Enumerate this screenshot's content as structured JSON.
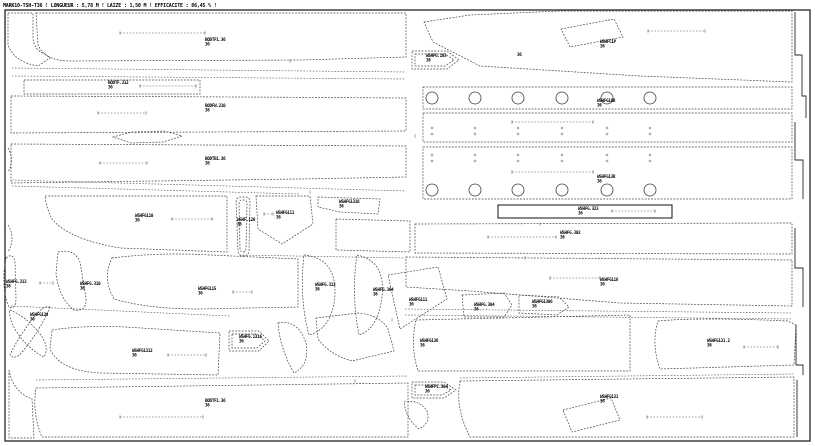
{
  "header": {
    "text": "MARK10-TSH-T36 ! LONGUEUR : 5,78 M ! LAIZE : 1,50 M ! EFFICACITE : 86,45 % !"
  },
  "canvas": {
    "background": "#ffffff",
    "line_color": "#3c3c3c",
    "label_color": "#000000"
  },
  "pieces": [
    {
      "label": "BODTF1.36",
      "size": "36",
      "x": 205,
      "y": 41
    },
    {
      "label": "WSHFC1P",
      "size": "36",
      "x": 600,
      "y": 43
    },
    {
      "label": "WSHFG.103",
      "size": "36",
      "x": 426,
      "y": 57
    },
    {
      "label": "36",
      "size": "",
      "x": 517,
      "y": 56
    },
    {
      "label": "WSHFG10B",
      "size": "36",
      "x": 597,
      "y": 102
    },
    {
      "label": "BODTF.312",
      "size": "36",
      "x": 108,
      "y": 84
    },
    {
      "label": "BODFW.210",
      "size": "36",
      "x": 205,
      "y": 107
    },
    {
      "label": "BODTB1.36",
      "size": "36",
      "x": 205,
      "y": 160
    },
    {
      "label": "WSHFG13B",
      "size": "36",
      "x": 597,
      "y": 178
    },
    {
      "label": "WSHFG110",
      "size": "36",
      "x": 135,
      "y": 217
    },
    {
      "label": "WSHF.120",
      "size": "36",
      "x": 237,
      "y": 221
    },
    {
      "label": "WSHFG111",
      "size": "36",
      "x": 276,
      "y": 214
    },
    {
      "label": "WSHFG1316",
      "size": "36",
      "x": 339,
      "y": 203
    },
    {
      "label": "WSHFG.323",
      "size": "36",
      "x": 578,
      "y": 210
    },
    {
      "label": "WSHFG.302",
      "size": "36",
      "x": 560,
      "y": 234
    },
    {
      "label": "WSHFG.313",
      "size": "36",
      "x": 6,
      "y": 283
    },
    {
      "label": "WSHFG.310",
      "size": "36",
      "x": 80,
      "y": 285
    },
    {
      "label": "WSHFG115",
      "size": "36",
      "x": 198,
      "y": 290
    },
    {
      "label": "WSHFG.313",
      "size": "36",
      "x": 315,
      "y": 286
    },
    {
      "label": "WSHFG.304",
      "size": "36",
      "x": 373,
      "y": 291
    },
    {
      "label": "WSHFG111",
      "size": "36",
      "x": 409,
      "y": 301
    },
    {
      "label": "WSHFG.304",
      "size": "36",
      "x": 474,
      "y": 306
    },
    {
      "label": "WSHFG1306",
      "size": "36",
      "x": 532,
      "y": 303
    },
    {
      "label": "WSHFG116",
      "size": "36",
      "x": 600,
      "y": 281
    },
    {
      "label": "WSHFG138",
      "size": "36",
      "x": 30,
      "y": 316
    },
    {
      "label": "WSHFG1312",
      "size": "36",
      "x": 132,
      "y": 352
    },
    {
      "label": "WSHFG.1316",
      "size": "36",
      "x": 239,
      "y": 338
    },
    {
      "label": "WSHFG136",
      "size": "36",
      "x": 420,
      "y": 342
    },
    {
      "label": "WSHFG131.2",
      "size": "36",
      "x": 707,
      "y": 342
    },
    {
      "label": "WSHFPL.304",
      "size": "36",
      "x": 425,
      "y": 388
    },
    {
      "label": "WSHFG131",
      "size": "36",
      "x": 600,
      "y": 398
    },
    {
      "label": "BODTF1.36",
      "size": "36",
      "x": 205,
      "y": 402
    }
  ],
  "grain_lines": [
    {
      "x1": 120,
      "y1": 33,
      "x2": 205,
      "y2": 33
    },
    {
      "x1": 648,
      "y1": 31,
      "x2": 705,
      "y2": 31
    },
    {
      "x1": 140,
      "y1": 86,
      "x2": 196,
      "y2": 86
    },
    {
      "x1": 98,
      "y1": 113,
      "x2": 146,
      "y2": 113
    },
    {
      "x1": 100,
      "y1": 163,
      "x2": 147,
      "y2": 163
    },
    {
      "x1": 512,
      "y1": 122,
      "x2": 593,
      "y2": 122
    },
    {
      "x1": 512,
      "y1": 172,
      "x2": 593,
      "y2": 172
    },
    {
      "x1": 488,
      "y1": 237,
      "x2": 556,
      "y2": 237
    },
    {
      "x1": 550,
      "y1": 278,
      "x2": 600,
      "y2": 278
    },
    {
      "x1": 172,
      "y1": 219,
      "x2": 212,
      "y2": 219
    },
    {
      "x1": 264,
      "y1": 214,
      "x2": 273,
      "y2": 214
    },
    {
      "x1": 612,
      "y1": 211,
      "x2": 655,
      "y2": 211
    },
    {
      "x1": 40,
      "y1": 283,
      "x2": 53,
      "y2": 283
    },
    {
      "x1": 233,
      "y1": 292,
      "x2": 252,
      "y2": 292
    },
    {
      "x1": 120,
      "y1": 417,
      "x2": 203,
      "y2": 417
    },
    {
      "x1": 647,
      "y1": 417,
      "x2": 702,
      "y2": 417
    },
    {
      "x1": 168,
      "y1": 355,
      "x2": 206,
      "y2": 355
    },
    {
      "x1": 744,
      "y1": 347,
      "x2": 778,
      "y2": 347
    }
  ],
  "drill_rows": [
    {
      "y": 98,
      "r": 6,
      "xs": [
        432,
        475,
        518,
        562,
        607,
        650
      ]
    },
    {
      "y": 190,
      "r": 6,
      "xs": [
        432,
        475,
        518,
        562,
        607,
        650
      ]
    }
  ],
  "notch_rows": [
    {
      "y": 128,
      "xs": [
        432,
        475,
        518,
        562,
        607,
        650
      ]
    },
    {
      "y": 134,
      "xs": [
        432,
        475,
        518,
        562,
        607,
        650
      ]
    },
    {
      "y": 155,
      "xs": [
        432,
        475,
        518,
        562,
        607,
        650
      ]
    },
    {
      "y": 161,
      "xs": [
        432,
        475,
        518,
        562,
        607,
        650
      ]
    }
  ],
  "edge_ticks": [
    {
      "x": 290,
      "y": 61
    },
    {
      "x": 415,
      "y": 136
    },
    {
      "x": 540,
      "y": 224
    },
    {
      "x": 310,
      "y": 192
    },
    {
      "x": 355,
      "y": 381
    },
    {
      "x": 525,
      "y": 258
    },
    {
      "x": 392,
      "y": 320
    }
  ]
}
